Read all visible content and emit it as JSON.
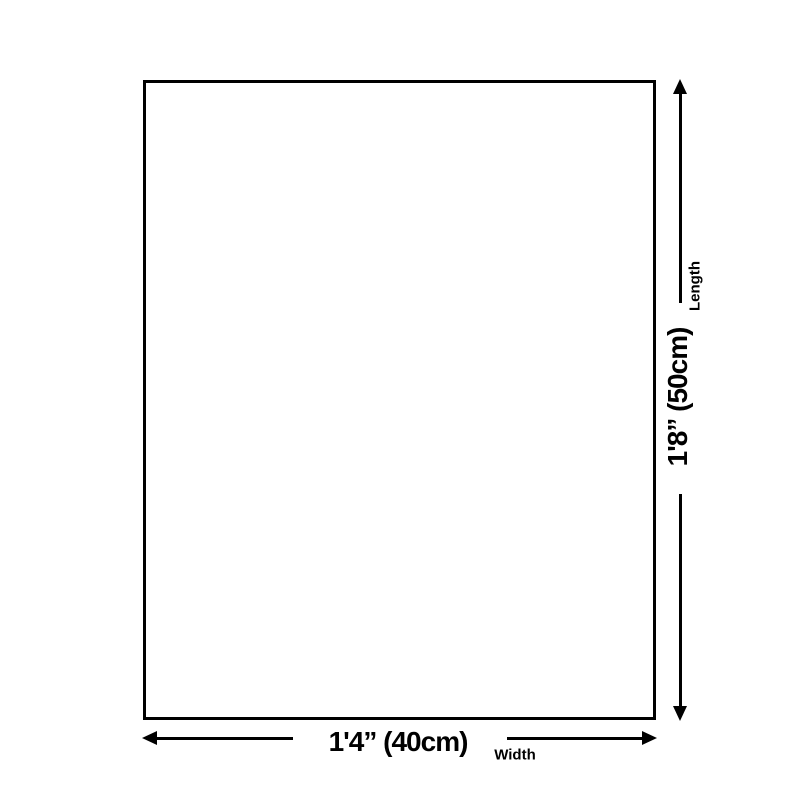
{
  "diagram": {
    "length_dimension": {
      "value": "1'8” (50cm)",
      "axis_label": "Length"
    },
    "width_dimension": {
      "value": "1'4” (40cm)",
      "axis_label": "Width"
    }
  },
  "colors": {
    "line": "#000000",
    "text": "#000000",
    "bg": "#ffffff",
    "rect-fill": "#ffffff"
  }
}
